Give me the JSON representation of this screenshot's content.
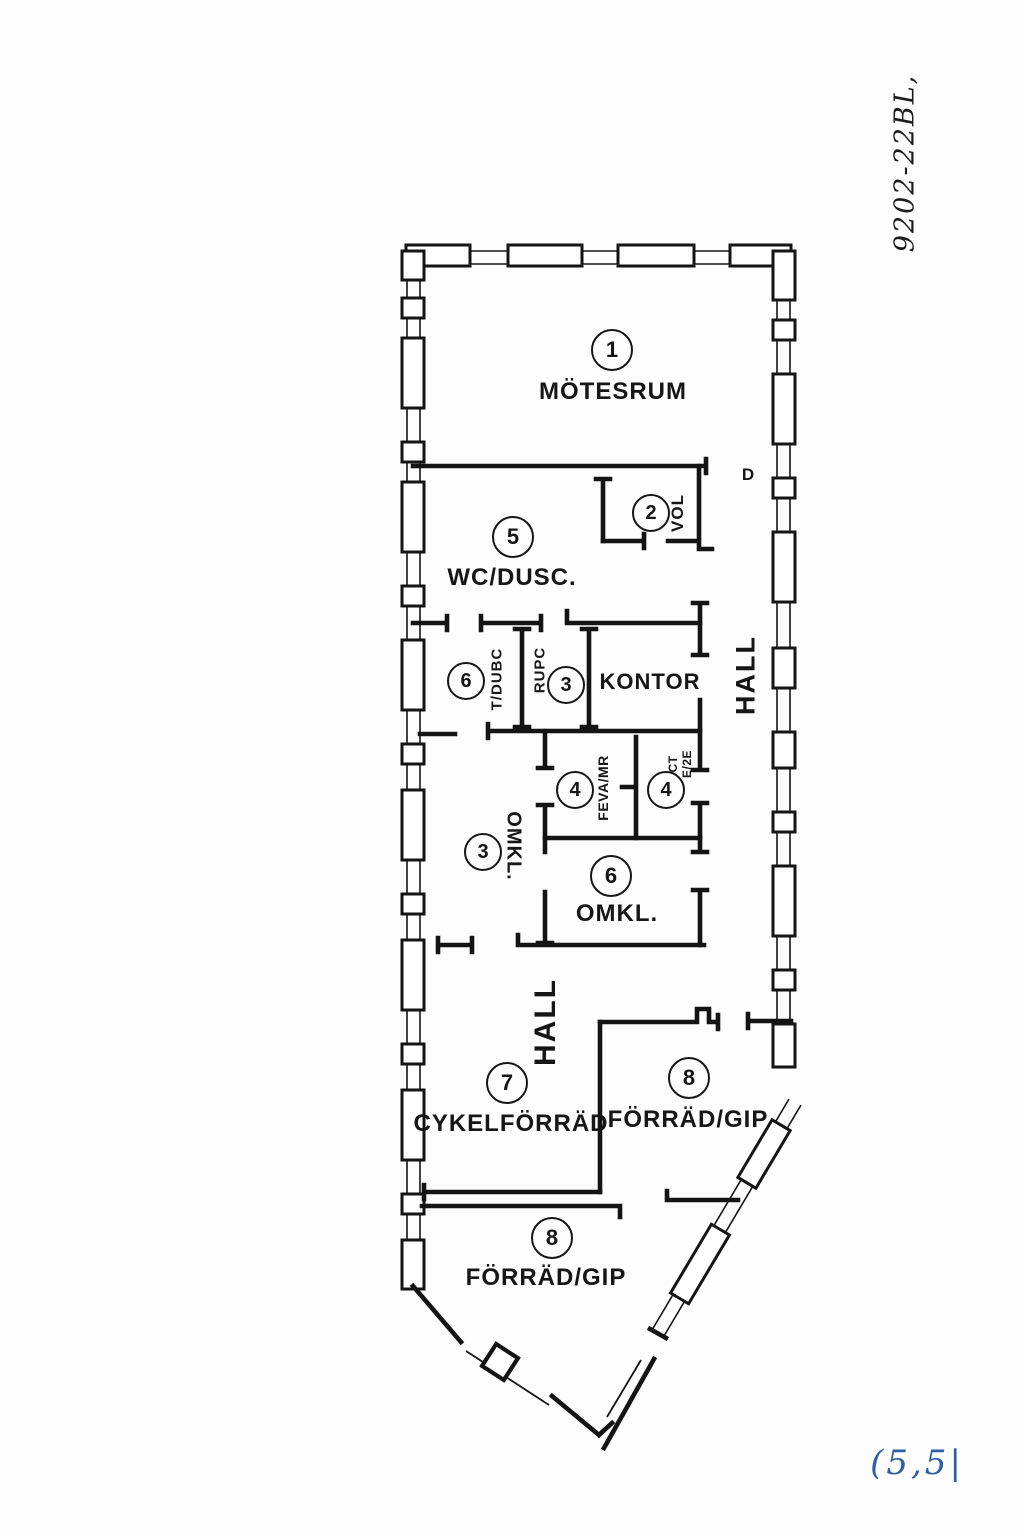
{
  "annotations": {
    "doc_number": "9202-22BL,",
    "page_mark": "(5,5|",
    "page_mark_color": "#2e5fa6",
    "ink_color": "#141414"
  },
  "labels": {
    "door": "D",
    "hall_upper": "HALL",
    "hall_lower": "HALL",
    "kontor": "KONTOR"
  },
  "rooms": [
    {
      "number": "1",
      "label": "MÖTESRUM"
    },
    {
      "number": "2",
      "label": "VOL"
    },
    {
      "number": "5",
      "label": "WC/DUSC."
    },
    {
      "number": "6",
      "label": "T/DUBC"
    },
    {
      "number": "3",
      "label": "RUPC"
    },
    {
      "number": "4",
      "label": "FEVA/MR"
    },
    {
      "number": "4",
      "label": "CT\nE/2E"
    },
    {
      "number": "3",
      "label": "OMKL."
    },
    {
      "number": "6",
      "label": "OMKL."
    },
    {
      "number": "7",
      "label": "CYKELFÖRRÄD"
    },
    {
      "number": "8",
      "label": "FÖRRÄD/GIP"
    },
    {
      "number": "8",
      "label": "FÖRRÄD/GIP"
    }
  ]
}
